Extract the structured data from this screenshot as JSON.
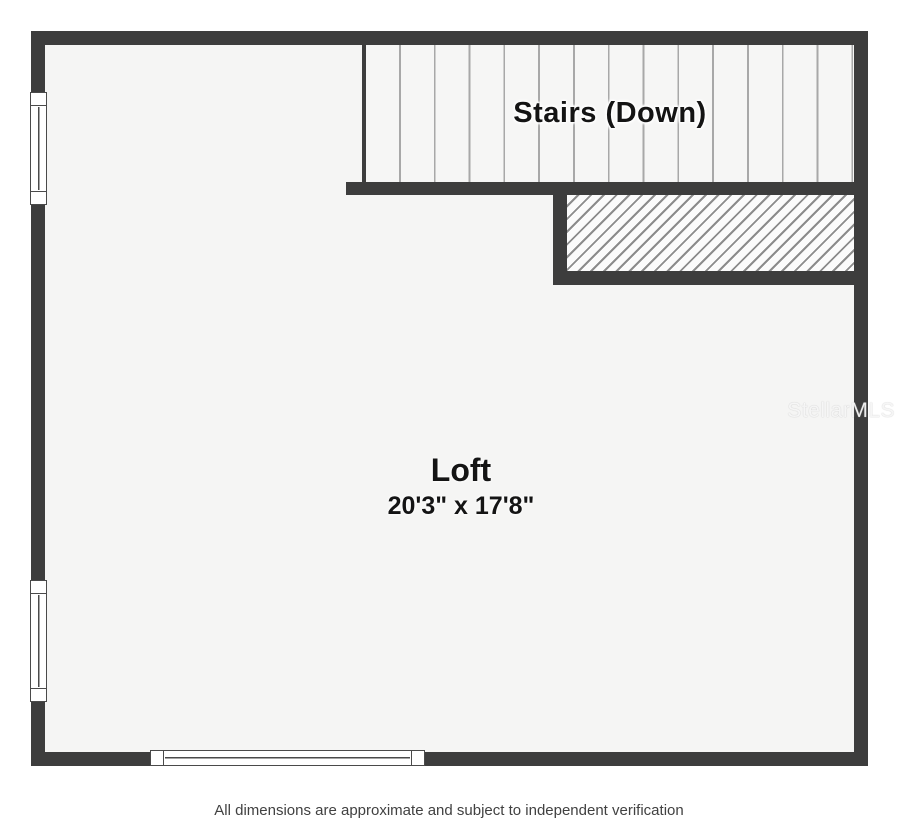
{
  "floorplan": {
    "stairs": {
      "label": "Stairs (Down)"
    },
    "loft": {
      "name": "Loft",
      "dimensions": "20'3\" x 17'8\""
    },
    "watermark": "StellarMLS"
  },
  "footer": {
    "disclaimer": "All dimensions are approximate and subject to independent verification"
  },
  "colors": {
    "wall": "#3d3d3d",
    "floor": "#f5f5f4",
    "stair-bg": "#f6f6f5",
    "tread-line": "#a8a8a8",
    "hatch-bg": "#fbfbfb",
    "hatch-line": "#8c8c8c",
    "window-frame": "#4a4a4a",
    "label-text": "#141414",
    "footer-text": "#414141"
  }
}
